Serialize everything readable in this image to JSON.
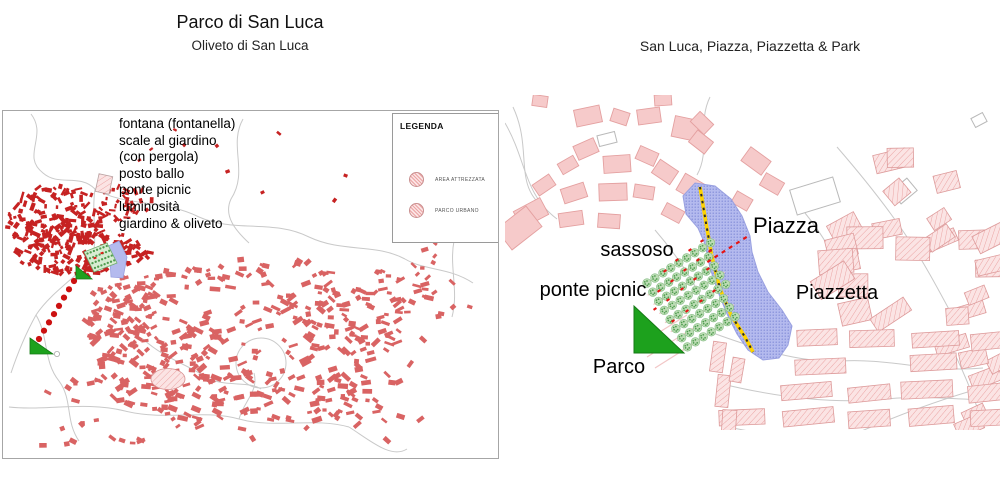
{
  "page": {
    "background": "#ffffff"
  },
  "left_panel": {
    "title": "Parco di San Luca",
    "subtitle": "Oliveto di San Luca",
    "annotations": [
      "fontana (fontanella)",
      "scale al giardino",
      "(con pergola)",
      "posto ballo",
      "ponte picnic",
      "luminosità",
      "giardino & oliveto"
    ],
    "legend": {
      "title": "LEGENDA",
      "items": [
        {
          "label": "AREA ATTREZZATA",
          "symbol": "hatched-circle"
        },
        {
          "label": "PARCO URBANO",
          "symbol": "hatched-circle"
        }
      ]
    }
  },
  "right_panel": {
    "title": "San Luca, Piazza, Piazzetta & Park",
    "labels": [
      {
        "text": "sassoso",
        "x": 132,
        "y": 144,
        "size": 20
      },
      {
        "text": "ponte picnic",
        "x": 88,
        "y": 184,
        "size": 20
      },
      {
        "text": "Piazza",
        "x": 281,
        "y": 118,
        "size": 22
      },
      {
        "text": "Piazzetta",
        "x": 332,
        "y": 187,
        "size": 20
      },
      {
        "text": "Parco",
        "x": 114,
        "y": 261,
        "size": 20
      }
    ]
  },
  "colors": {
    "historic_red": "#c62222",
    "town_red": "#d96363",
    "road_gray": "#c9c9c9",
    "solid_pink_fill": "#f6caca",
    "solid_pink_stroke": "#e4a0a0",
    "hatch_pink_bg": "#fbe4e4",
    "hatch_pink_line": "#eba4a4",
    "hatch_pink_stroke": "#dd9b9b",
    "piazza_purple": "#b4baee",
    "piazza_dot": "#7e88d6",
    "piazza_stroke": "#99a0e0",
    "stair_yellow": "#ffd300",
    "stair_dash": "#2a2a2a",
    "tree_green": "#bcdcb4",
    "tree_edge": "#85bd85",
    "tree_dot_green": "#4e9c4e",
    "triangle_green": "#1da11d",
    "triangle_edge": "#157a15",
    "mark_red": "#e51414",
    "dot_red": "#cc1111",
    "terrace_pink": "#f2c6c6"
  },
  "map_left": {
    "roads": [
      "M28,3 C45,25 18,45 40,62 C56,76 76,62 92,78",
      "M240,8 C225,35 246,60 228,88 C220,105 233,120 246,132",
      "M92,78 C122,96 160,88 196,106 C232,122 270,108 306,126 C340,142 372,132 402,148",
      "M92,78 C88,106 96,130 88,150",
      "M88,150 C70,168 46,184 33,204 C23,222 14,244 8,262",
      "M33,204 C46,226 40,250 56,270 C70,289 62,310 76,330",
      "M6,296 C42,300 82,290 122,300 C162,310 202,298 236,308 C272,318 310,306 346,316",
      "M236,308 C241,290 256,280 251,262",
      "M402,148 C422,160 446,156 470,172",
      "M452,38 C446,70 461,100 451,130 C446,156 456,180 449,206",
      "M346,316 C368,330 388,348 404,338",
      "M140,228 C162,248 186,254 206,268",
      "M206,268 C226,276 246,270 258,278"
    ],
    "ring_road": {
      "cx": 258,
      "cy": 252,
      "r": 25
    },
    "clusters": [
      {
        "name": "historic-a",
        "shape": "ellipse",
        "cx": 55,
        "cy": 108,
        "rx": 52,
        "ry": 34,
        "count": 150,
        "wMin": 3,
        "wMax": 9,
        "hMin": 2,
        "hMax": 4.5,
        "rotMax": 90,
        "color": "historic_red",
        "seed": 11
      },
      {
        "name": "historic-b",
        "shape": "ellipse",
        "cx": 80,
        "cy": 142,
        "rx": 68,
        "ry": 23,
        "count": 130,
        "wMin": 3,
        "wMax": 9,
        "hMin": 2,
        "hMax": 4.5,
        "rotMax": 90,
        "color": "historic_red",
        "seed": 12
      },
      {
        "name": "historic-arm",
        "shape": "ellipse",
        "cx": 120,
        "cy": 92,
        "rx": 30,
        "ry": 18,
        "count": 35,
        "wMin": 3,
        "wMax": 8,
        "hMin": 2,
        "hMax": 4,
        "rotMax": 90,
        "color": "historic_red",
        "seed": 13
      },
      {
        "name": "town-core",
        "shape": "ellipse",
        "cx": 240,
        "cy": 232,
        "rx": 165,
        "ry": 88,
        "count": 320,
        "wMin": 4,
        "wMax": 11,
        "hMin": 2.5,
        "hMax": 5.5,
        "rotMax": 45,
        "color": "town_red",
        "seed": 21
      },
      {
        "name": "town-west",
        "shape": "ellipse",
        "cx": 122,
        "cy": 205,
        "rx": 38,
        "ry": 48,
        "count": 70,
        "wMin": 4,
        "wMax": 10,
        "hMin": 2.5,
        "hMax": 5,
        "rotMax": 60,
        "color": "town_red",
        "seed": 22
      },
      {
        "name": "town-east",
        "shape": "ellipse",
        "cx": 360,
        "cy": 200,
        "rx": 80,
        "ry": 45,
        "count": 60,
        "wMin": 4,
        "wMax": 10,
        "hMin": 2.5,
        "hMax": 5,
        "rotMax": 45,
        "color": "town_red",
        "seed": 23
      },
      {
        "name": "south-scatter",
        "shape": "rect",
        "x0": 30,
        "y0": 255,
        "x1": 330,
        "y1": 335,
        "count": 45,
        "wMin": 4,
        "wMax": 9,
        "hMin": 2.5,
        "hMax": 5,
        "rotMax": 60,
        "color": "town_red",
        "seed": 24
      },
      {
        "name": "north-scatter",
        "shape": "rect",
        "x0": 110,
        "y0": 15,
        "x1": 360,
        "y1": 95,
        "count": 10,
        "wMin": 2.5,
        "wMax": 5,
        "hMin": 2,
        "hMax": 3.5,
        "rotMax": 60,
        "color": "historic_red",
        "seed": 25
      },
      {
        "name": "se-scatter",
        "shape": "rect",
        "x0": 330,
        "y0": 250,
        "x1": 430,
        "y1": 330,
        "count": 18,
        "wMin": 4,
        "wMax": 9,
        "hMin": 2.5,
        "hMax": 5,
        "rotMax": 60,
        "color": "town_red",
        "seed": 26
      },
      {
        "name": "east-road-scatter",
        "shape": "rect",
        "x0": 400,
        "y0": 130,
        "x1": 480,
        "y1": 230,
        "count": 14,
        "wMin": 4,
        "wMax": 8,
        "hMin": 2.5,
        "hMax": 4.5,
        "rotMax": 60,
        "color": "town_red",
        "seed": 27
      }
    ],
    "outline_building": [
      101,
      73,
      14,
      18,
      12
    ],
    "hatched_ellipse": {
      "cx": 165,
      "cy": 268,
      "rx": 17,
      "ry": 10.5
    },
    "park": {
      "polygon": "81,141 104,132 114,152 91,161",
      "fill": "#d8ecd2",
      "stroke": "#6fae6f",
      "dot_rows": 4,
      "dots_per_row": 7,
      "origin": [
        84.5,
        142.5
      ],
      "row_step": [
        2.5,
        4.8
      ],
      "dot_step": [
        3.2,
        -1.25
      ],
      "red_marks": [
        [
          92,
          147
        ],
        [
          99,
          142
        ]
      ]
    },
    "piazza": {
      "polygon": "101,137 116,130 124,146 120,167 108,166 107,150"
    },
    "dotted_path": {
      "x1": 71,
      "y1": 170,
      "x2": 36,
      "y2": 228,
      "dots": 8,
      "r": 3.1
    },
    "triangles": [
      "73,155 73,168 89,168",
      "27,227 27,243 50,243"
    ],
    "small_circle": {
      "cx": 54,
      "cy": 243,
      "r": 2.6
    }
  },
  "map_right": {
    "roads": [
      "M8,12 C28,55 8,88 38,112",
      "M0,28 C22,66 18,98 52,124",
      "M205,2 C192,28 206,55 192,80",
      "M150,135 C170,158 185,180 198,206",
      "M332,52 C358,82 382,112 402,142 C418,166 432,192 446,218",
      "M300,118 C318,140 330,162 341,186",
      "M208,238 C252,254 295,268 336,266 C385,263 425,278 478,273",
      "M213,288 C262,300 322,310 382,304 C432,299 468,308 495,303",
      "M228,333 C282,344 342,349 402,344 C445,340 475,346 495,343",
      "M352,338 C398,318 448,300 495,288",
      "M440,240 C455,268 468,298 478,330"
    ],
    "solid_buildings": [
      [
        83,
        21,
        26,
        17,
        -12
      ],
      [
        115,
        22,
        17,
        13,
        18
      ],
      [
        144,
        21,
        23,
        15,
        -8
      ],
      [
        183,
        34,
        30,
        21,
        12
      ],
      [
        196,
        47,
        20,
        15,
        38
      ],
      [
        81,
        54,
        22,
        15,
        -24
      ],
      [
        63,
        70,
        18,
        12,
        -30
      ],
      [
        112,
        69,
        27,
        17,
        -4
      ],
      [
        142,
        61,
        20,
        14,
        24
      ],
      [
        160,
        77,
        22,
        16,
        34
      ],
      [
        187,
        93,
        26,
        19,
        30
      ],
      [
        39,
        90,
        20,
        13,
        -34
      ],
      [
        69,
        98,
        24,
        15,
        -18
      ],
      [
        108,
        97,
        28,
        17,
        -2
      ],
      [
        139,
        97,
        20,
        13,
        9
      ],
      [
        26,
        118,
        30,
        19,
        -28
      ],
      [
        66,
        124,
        24,
        14,
        -8
      ],
      [
        104,
        126,
        22,
        14,
        4
      ],
      [
        14,
        133,
        38,
        26,
        -38
      ],
      [
        168,
        118,
        20,
        13,
        28
      ],
      [
        197,
        28,
        19,
        14,
        44
      ],
      [
        251,
        66,
        25,
        17,
        36
      ],
      [
        267,
        89,
        21,
        14,
        30
      ],
      [
        158,
        5,
        17,
        11,
        -4
      ],
      [
        35,
        6,
        15,
        11,
        8
      ],
      [
        237,
        106,
        18,
        13,
        30
      ]
    ],
    "white_buildings": [
      [
        310,
        101,
        45,
        26,
        -17
      ],
      [
        399,
        96,
        21,
        16,
        -40
      ],
      [
        474,
        25,
        13,
        10,
        -28
      ],
      [
        102,
        44,
        18,
        11,
        -14
      ]
    ],
    "hatch_clusters": [
      {
        "bbox": [
          332,
          58,
          488,
          162
        ],
        "count": 11,
        "wMin": 20,
        "wMax": 34,
        "hMin": 13,
        "hMax": 20,
        "rotMin": -40,
        "rotMax": 0,
        "seed": 31
      },
      {
        "bbox": [
          298,
          142,
          432,
          236
        ],
        "count": 9,
        "wMin": 26,
        "wMax": 44,
        "hMin": 15,
        "hMax": 24,
        "rotMin": -35,
        "rotMax": 5,
        "seed": 32
      },
      {
        "bbox": [
          432,
          150,
          495,
          238
        ],
        "count": 5,
        "wMin": 20,
        "wMax": 30,
        "hMin": 13,
        "hMax": 18,
        "rotMin": -30,
        "rotMax": 0,
        "seed": 33
      },
      {
        "bbox": [
          432,
          238,
          495,
          338
        ],
        "count": 6,
        "wMin": 22,
        "wMax": 34,
        "hMin": 14,
        "hMax": 20,
        "rotMin": -28,
        "rotMax": -5,
        "seed": 34
      }
    ],
    "hatch_rows": {
      "ys": [
        243,
        269,
        296,
        322
      ],
      "x0": [
        292,
        290,
        218,
        214
      ],
      "x1": 495,
      "w": 46,
      "h": 14.5,
      "rot": -6,
      "seed": 35
    },
    "hatch_vert": [
      [
        213,
        262,
        13,
        30,
        8
      ],
      [
        218,
        296,
        13,
        32,
        6
      ],
      [
        224,
        328,
        14,
        26,
        4
      ],
      [
        232,
        275,
        12,
        24,
        10
      ]
    ],
    "piazza_polygon": "178,101 190,88 210,91 226,104 237,121 245,141 247,157 253,177 263,197 277,215 287,231 283,250 274,263 258,265 243,255 232,239 222,219 213,197 205,173 200,149 193,133 181,119",
    "yellow_line": "195,92 201,128 207,162 215,194 226,220 240,242 248,257",
    "park": {
      "origin": [
        142,
        188
      ],
      "dir": [
        0.845,
        -0.535
      ],
      "perp": [
        0.535,
        0.845
      ],
      "row_step": 10.8,
      "tree_step": 9.4,
      "rows": 8,
      "per_row": 12,
      "boundary": {
        "x0": 186,
        "y0": 90,
        "slope": 0.37
      },
      "extra_terraces": [
        [
          137,
          248,
          182,
          220
        ],
        [
          142,
          262,
          190,
          232
        ],
        [
          150,
          273,
          196,
          244
        ]
      ],
      "red_marks": [
        [
          160,
          176
        ],
        [
          172,
          165
        ],
        [
          185,
          155
        ],
        [
          197,
          146
        ],
        [
          154,
          196
        ],
        [
          167,
          186
        ],
        [
          180,
          175
        ],
        [
          193,
          165
        ],
        [
          205,
          156
        ],
        [
          150,
          214
        ],
        [
          163,
          205
        ],
        [
          177,
          194
        ],
        [
          190,
          184
        ],
        [
          203,
          174
        ],
        [
          168,
          226
        ],
        [
          182,
          216
        ],
        [
          196,
          206
        ],
        [
          209,
          196
        ]
      ]
    },
    "edge_marks": {
      "x1": 204,
      "y1": 166,
      "x2": 240,
      "y2": 143,
      "count": 6
    },
    "triangle": "129,211 129,258 179,258"
  }
}
